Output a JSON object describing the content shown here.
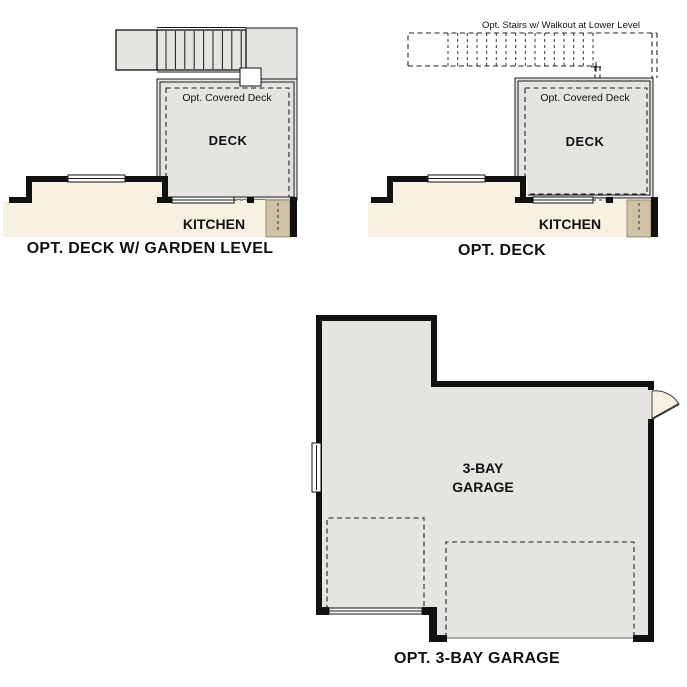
{
  "colors": {
    "background": "#ffffff",
    "wall": "#111111",
    "deck_floor": "#e5e4e1",
    "kitchen_floor": "#f7f1e2",
    "stair_strip_tan": "#cfc2a5",
    "door_swing": "#f8f0e0"
  },
  "plan_deck_garden": {
    "title": "OPT. DECK W/ GARDEN LEVEL",
    "covered_deck_label": "Opt. Covered Deck",
    "deck_label": "DECK",
    "kitchen_label": "KITCHEN"
  },
  "plan_deck": {
    "title": "OPT. DECK",
    "stairs_label": "Opt. Stairs w/ Walkout at Lower Level",
    "covered_deck_label": "Opt. Covered Deck",
    "deck_label": "DECK",
    "kitchen_label": "KITCHEN"
  },
  "plan_garage": {
    "title": "OPT. 3-BAY GARAGE",
    "room_label_line1": "3-BAY",
    "room_label_line2": "GARAGE"
  }
}
